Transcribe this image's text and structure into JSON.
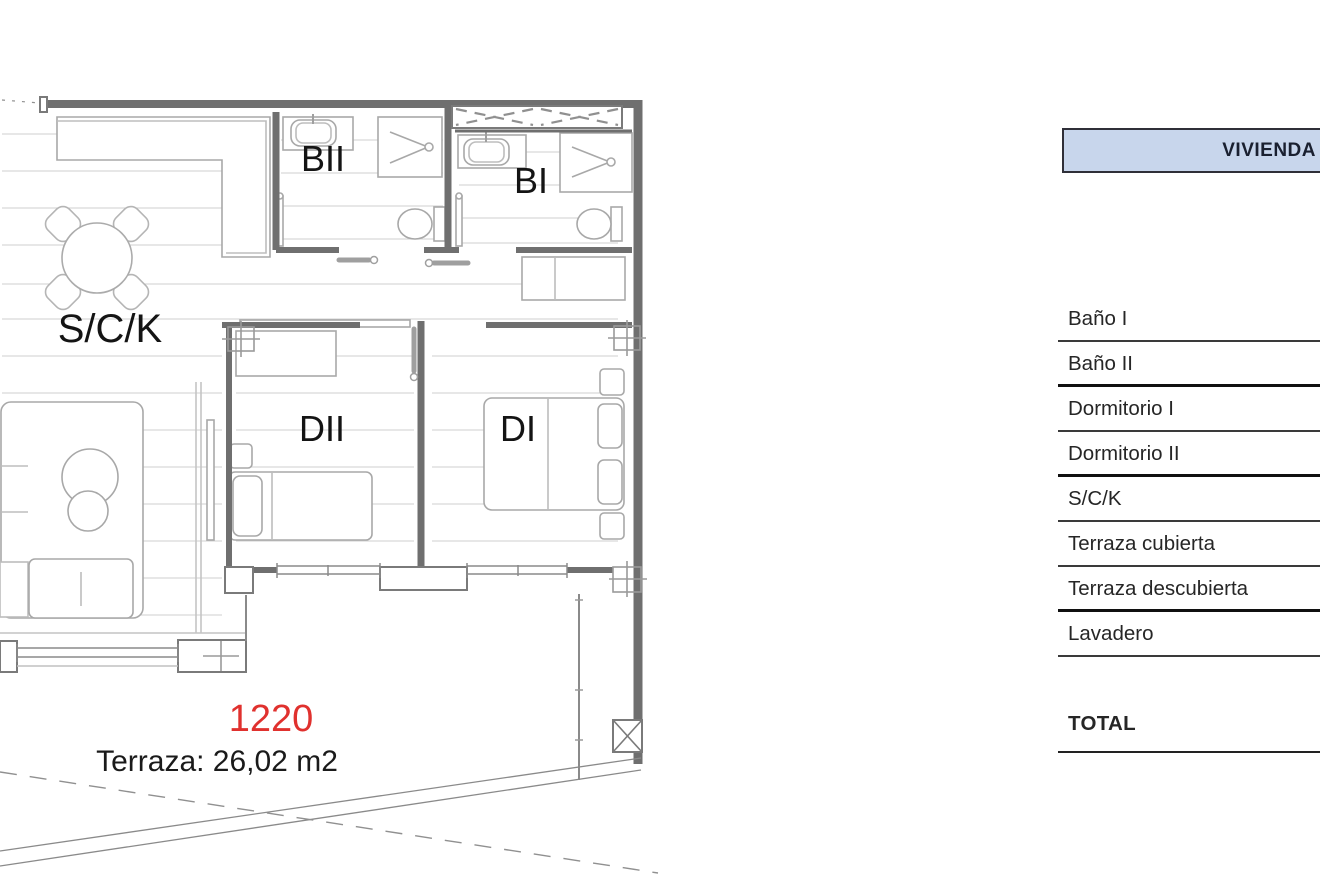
{
  "plan": {
    "unit_number": "1220",
    "terrace_note": "Terraza: 26,02 m2",
    "labels": {
      "living": "S/C/K",
      "bath2": "BII",
      "bath1": "BI",
      "bed2": "DII",
      "bed1": "DI"
    }
  },
  "table": {
    "header": "VIVIENDA",
    "rows": [
      {
        "label": "Baño I",
        "divider": "thin"
      },
      {
        "label": "Baño II",
        "divider": "thick"
      },
      {
        "label": "Dormitorio I",
        "divider": "thin"
      },
      {
        "label": "Dormitorio II",
        "divider": "thick"
      },
      {
        "label": "S/C/K",
        "divider": "thin"
      },
      {
        "label": "Terraza cubierta",
        "divider": "thin"
      },
      {
        "label": "Terraza descubierta",
        "divider": "thick"
      },
      {
        "label": "Lavadero",
        "divider": "thin"
      }
    ],
    "total_label": "TOTAL"
  },
  "colors": {
    "unit_number_red": "#e0312e",
    "table_header_fill": "#c8d6ec",
    "table_header_border": "#2f2f38",
    "wall_gray": "#6f6f6f"
  }
}
